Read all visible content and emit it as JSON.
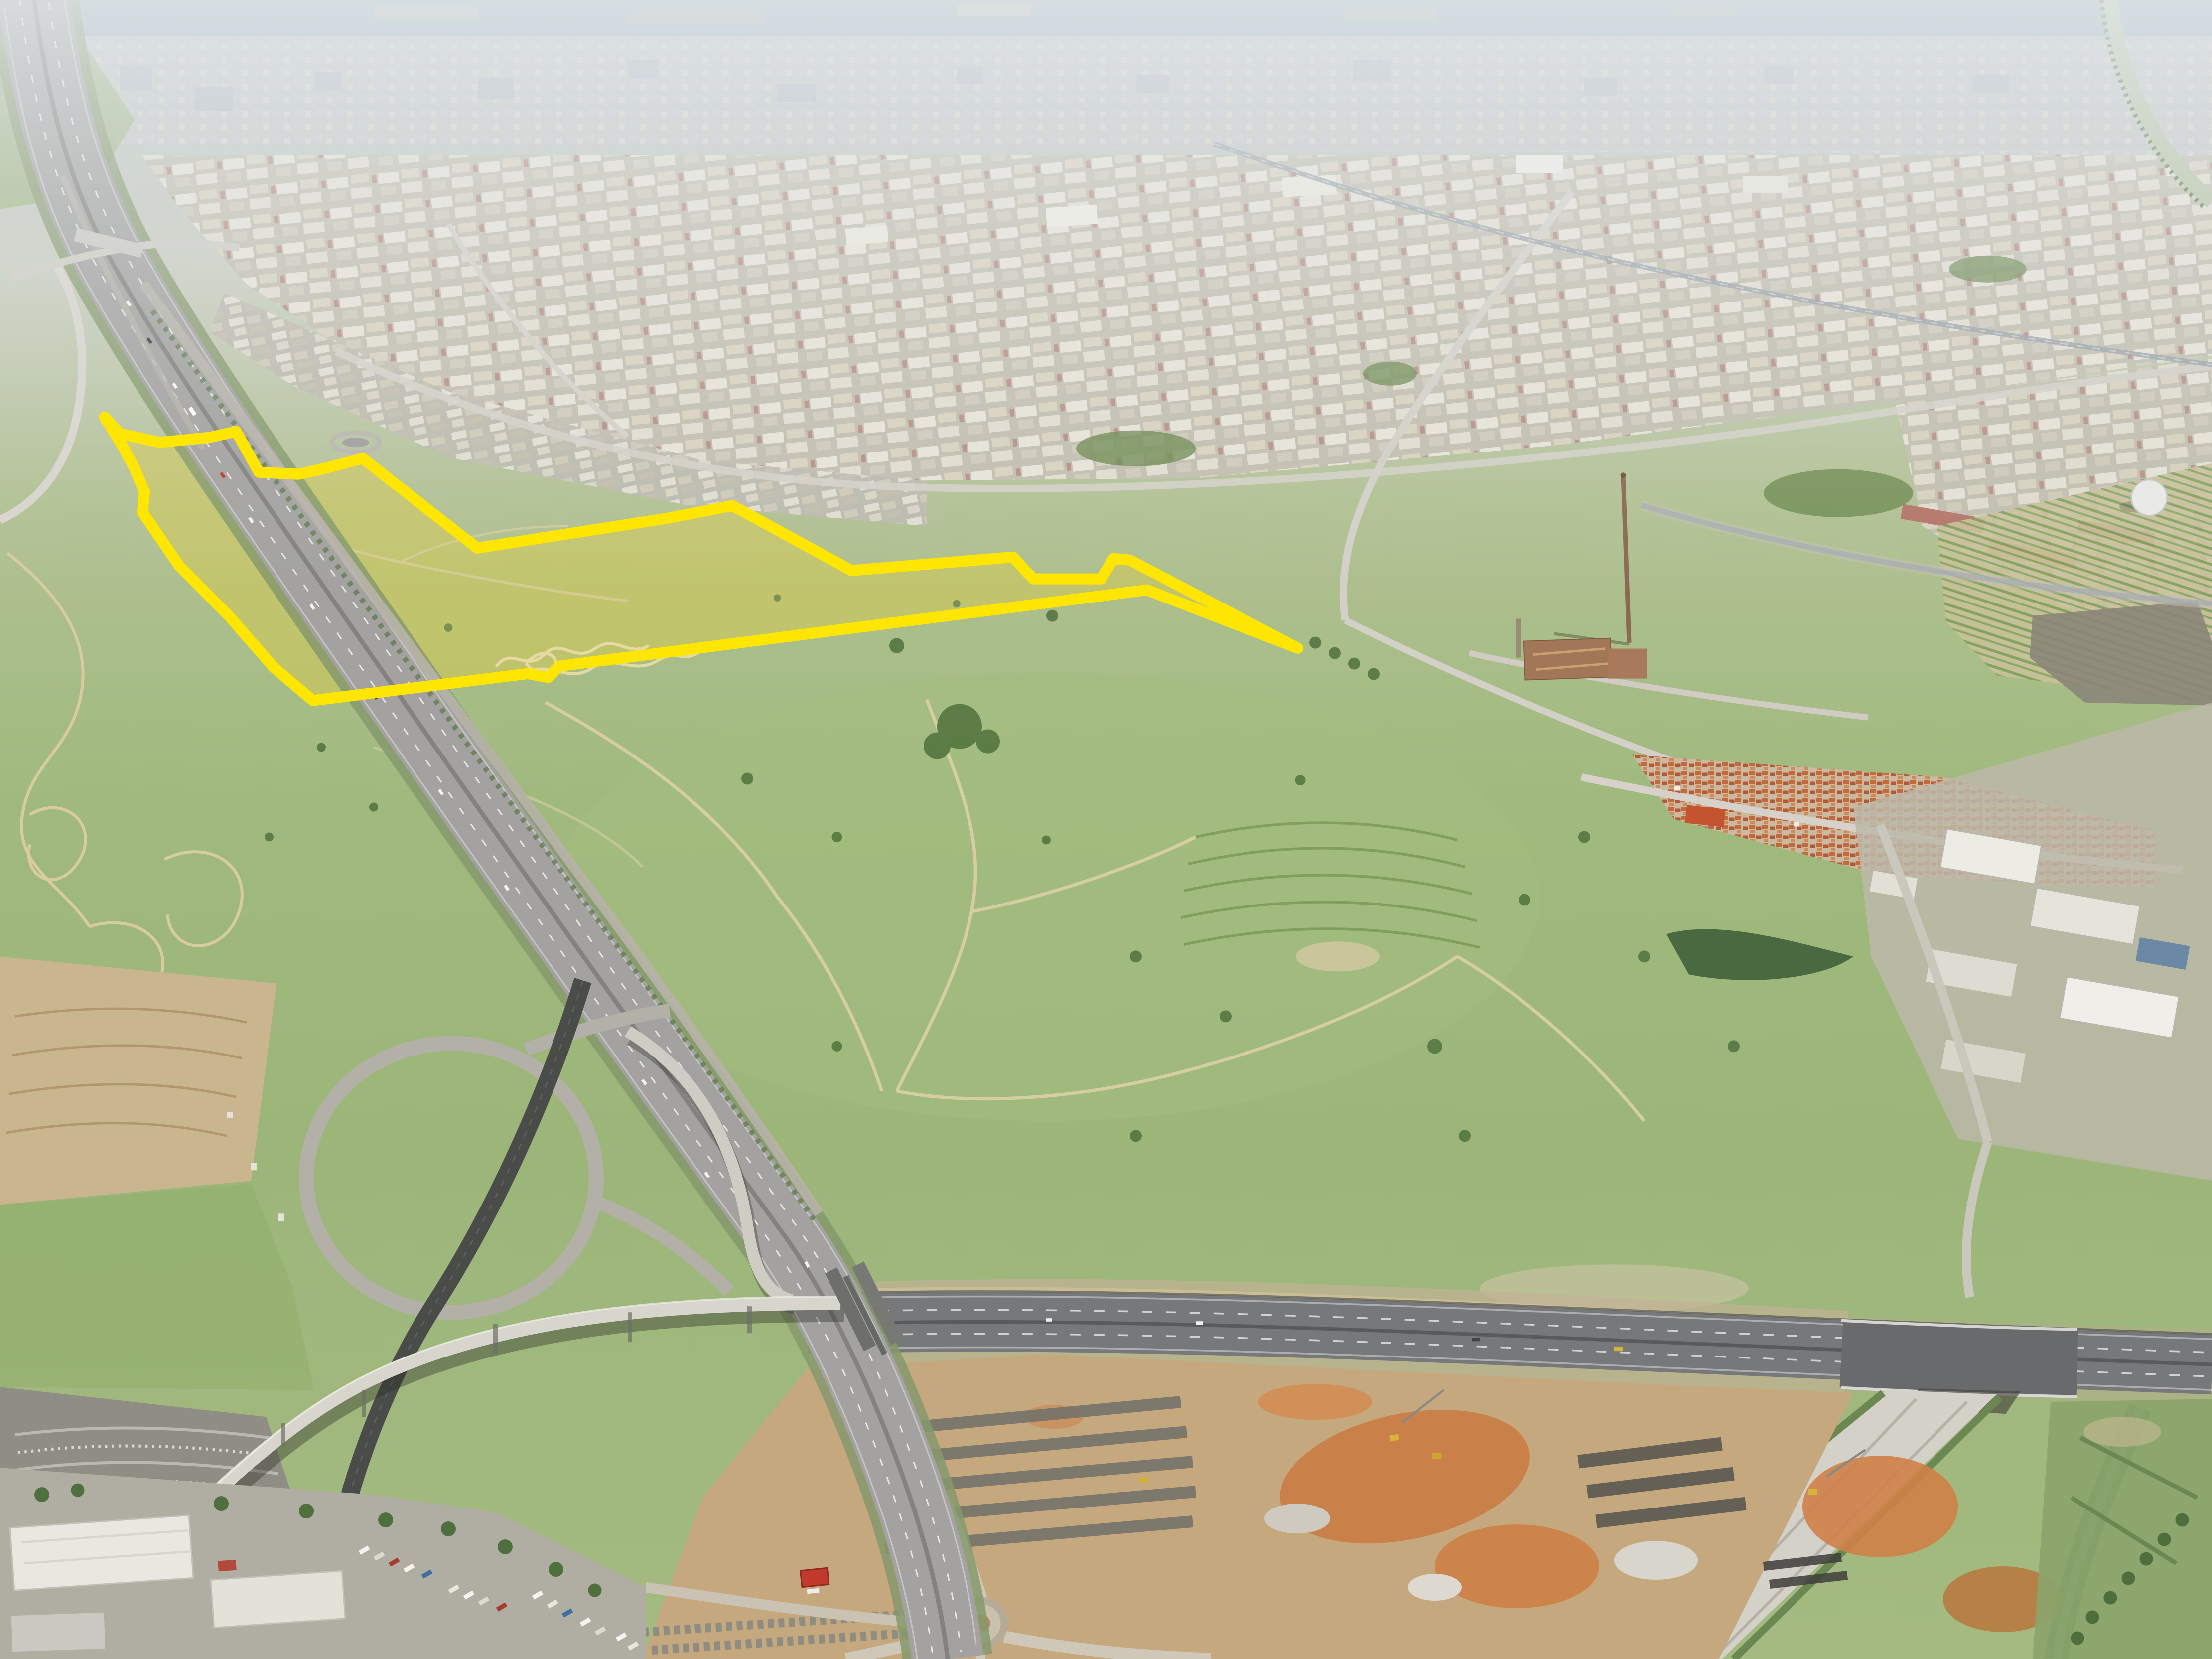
{
  "image": {
    "type": "oblique aerial photograph",
    "description": "Aerial view over city outskirts: hazy skyline and sea on the horizon, industrial estates across the upper half, a motorway running from top-left to bottom-centre with a looping interchange and elevated viaduct, a new highway under construction with orange earthworks across the lower third, green vacant land in the middle with a development parcel of dry yellow grassland outlined by a thick yellow boundary, truck depots bottom-left, and a village, sheds, orchards and an old factory with a tall chimney on the right."
  },
  "parcel": {
    "name": "highlighted-land-parcel",
    "stroke_color": "#ffe600",
    "stroke_width": "7.4",
    "fill_color": "#d6c94e",
    "fill_opacity": "0.5",
    "outline_points": "70,279 80,290 106.7,296 140,292.7 158,288.7 173.3,316 200,317.3 220,312.7 242.7,306.7 319.3,366.7 446.7,346.7 490,338.3 569.7,381.7 677.7,372.7 691.3,387.3 736.7,387.3 745,373.7 756,374.7 868.3,433.7 767.3,394.7 374.3,445.7 366.7,453.3 353.3,450.7 209.3,468.7 183.3,446.7 153.3,412.3 120,378.7 95.3,342.7 96.7,329.3 90,313.3 81.7,298"
  },
  "palette": {
    "sea": "#9fb2ba",
    "haze": "#e6ebee",
    "far_city": "#c6c9cf",
    "industrial_roof": "#e7e3d8",
    "field_green": "#9eb97e",
    "dry_grass": "#d6c94e",
    "motorway_asphalt": "#a3a2a0",
    "new_road_asphalt": "#77787a",
    "earth_tan": "#c8ab82",
    "earth_orange": "#c97a40",
    "village_roof": "#c06a3e"
  }
}
